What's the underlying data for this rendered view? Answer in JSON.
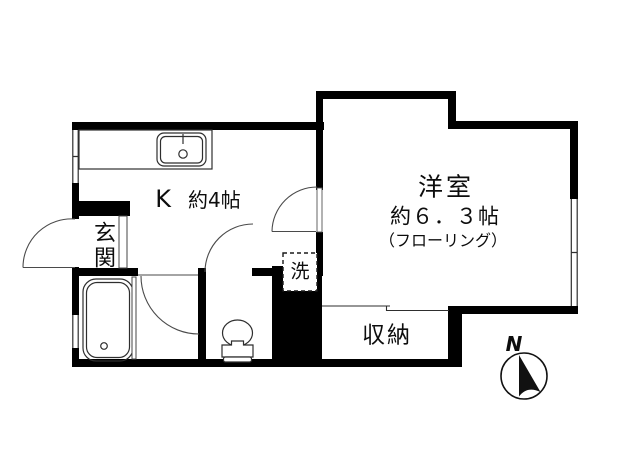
{
  "floorplan": {
    "kitchen": {
      "name": "K",
      "area": "約4帖"
    },
    "western_room": {
      "name": "洋室",
      "area": "約６．３帖",
      "flooring": "（フローリング）"
    },
    "storage": {
      "label": "収納"
    },
    "entrance": {
      "label": "玄関"
    },
    "washing_machine": {
      "label": "洗"
    },
    "compass": {
      "label": "N"
    },
    "colors": {
      "wall": "#000000",
      "thin_line": "#2e2e2e",
      "door_arc": "#4a4a4a",
      "background": "#ffffff"
    }
  }
}
